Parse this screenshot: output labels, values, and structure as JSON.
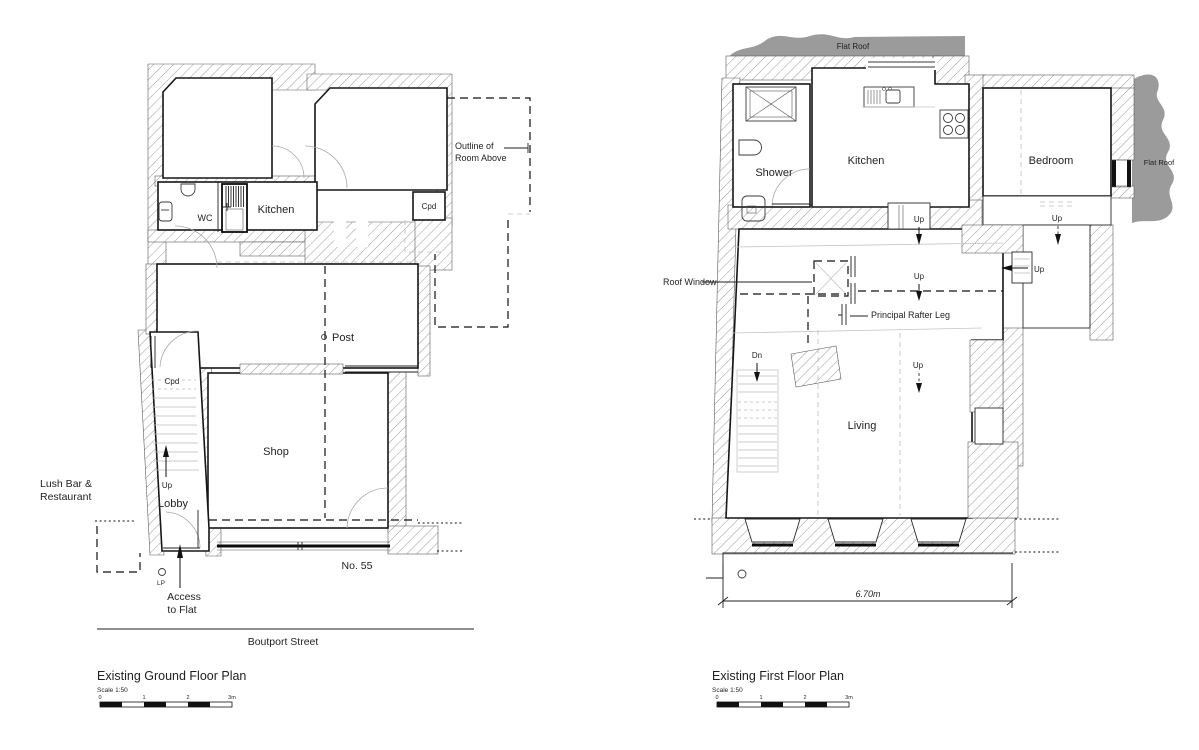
{
  "page": {
    "background": "#ffffff",
    "line_color": "#1a1a1a",
    "hatch_color": "#8a8a8a",
    "roof_gray": "#9b9b9b"
  },
  "ground_floor": {
    "title": "Existing Ground Floor Plan",
    "scale_note": "Scale 1:50",
    "rooms": {
      "wc": "WC",
      "kitchen": "Kitchen",
      "cupboard_upper": "Cpd",
      "post": "Post",
      "cupboard_lobby": "Cpd",
      "shop": "Shop",
      "lobby": "Lobby"
    },
    "annotations": {
      "outline_line1": "Outline of",
      "outline_line2": "Room Above",
      "lush_line1": "Lush Bar &",
      "lush_line2": "Restaurant",
      "up": "Up",
      "lp": "LP",
      "access_line1": "Access",
      "access_line2": "to Flat",
      "house_number": "No. 55",
      "street": "Boutport Street"
    },
    "scale_bar": {
      "t0": "0",
      "t1": "1",
      "t2": "2",
      "t3": "3m"
    }
  },
  "first_floor": {
    "title": "Existing First Floor Plan",
    "scale_note": "Scale 1:50",
    "rooms": {
      "shower": "Shower",
      "kitchen": "Kitchen",
      "bedroom": "Bedroom",
      "living": "Living"
    },
    "annotations": {
      "flat_roof_top": "Flat Roof",
      "flat_roof_right": "Flat Roof",
      "roof_window": "Roof Window",
      "rafter": "Principal Rafter Leg",
      "up": "Up",
      "dn": "Dn",
      "dimension": "6.70m"
    },
    "scale_bar": {
      "t0": "0",
      "t1": "1",
      "t2": "2",
      "t3": "3m"
    }
  }
}
